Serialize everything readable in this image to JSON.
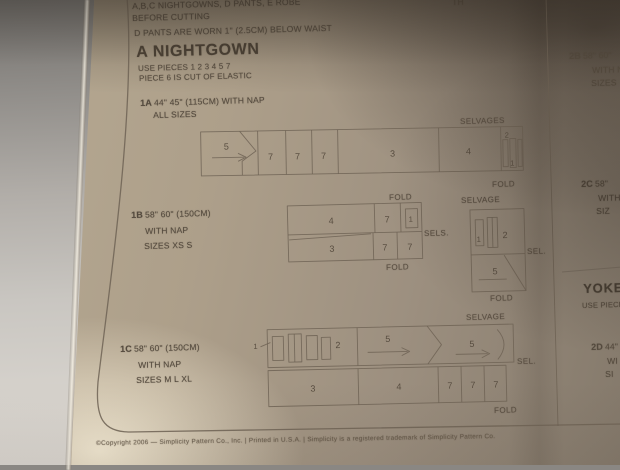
{
  "top_notes": {
    "line1": "A,B,C NIGHTGOWNS, D PANTS, E ROBE",
    "corner_fragment": "TH",
    "line2": "BEFORE CUTTING",
    "line3": "D PANTS ARE WORN 1\" (2.5CM) BELOW WAIST"
  },
  "nightgown": {
    "title": "A NIGHTGOWN",
    "use_pieces": "USE PIECES  1 2 3 4 5 7",
    "elastic_note": "PIECE 6 IS CUT OF ELASTIC"
  },
  "layout_1a": {
    "id": "1A",
    "fabric": "44\" 45\" (115CM) WITH NAP",
    "sizes": "ALL SIZES",
    "selvages_label": "SELVAGES",
    "fold_label": "FOLD",
    "pieces": {
      "p5": "5",
      "p7a": "7",
      "p7b": "7",
      "p7c": "7",
      "p3": "3",
      "p4": "4",
      "p2": "2",
      "p1": "1"
    }
  },
  "layout_1b": {
    "id": "1B",
    "fabric": "58\" 60\" (150CM)",
    "nap": "WITH NAP",
    "sizes": "SIZES XS S",
    "fold_top_label": "FOLD",
    "fold_bottom_label": "FOLD",
    "sels_label": "SELS.",
    "pieces": {
      "p4": "4",
      "p7a": "7",
      "p1": "1",
      "p3": "3",
      "p7b": "7",
      "p7c": "7"
    },
    "side_box": {
      "selvage_label": "SELVAGE",
      "sel_label": "SEL.",
      "fold_label": "FOLD",
      "pieces": {
        "p1": "1",
        "p2": "2",
        "p5": "5"
      }
    }
  },
  "layout_1c": {
    "id": "1C",
    "fabric": "58\" 60\" (150CM)",
    "nap": "WITH NAP",
    "sizes": "SIZES M L XL",
    "selvage_label": "SELVAGE",
    "sel_label": "SEL.",
    "fold_label": "FOLD",
    "pieces": {
      "p1": "1",
      "p2": "2",
      "p5a": "5",
      "p5b": "5",
      "p3": "3",
      "p4": "4",
      "p7a": "7",
      "p7b": "7",
      "p7c": "7"
    }
  },
  "right_column": {
    "item_2b": {
      "id": "2B",
      "fabric": "58\" 60\"",
      "nap": "WITH NAP",
      "sizes": "SIZES"
    },
    "item_2c": {
      "id": "2C",
      "fabric": "58\"",
      "nap": "WITH",
      "sizes": "SIZ"
    },
    "yoke": {
      "title": "YOKE",
      "use_pieces": "USE PIECES"
    },
    "item_2d": {
      "id": "2D",
      "fabric": "44\"",
      "nap": "WI",
      "sizes": "SI"
    }
  },
  "footer": {
    "copyright": "©Copyright 2006 — Simplicity Pattern Co., Inc.  |  Printed in U.S.A.  |  Simplicity is a registered trademark of Simplicity Pattern Co."
  }
}
